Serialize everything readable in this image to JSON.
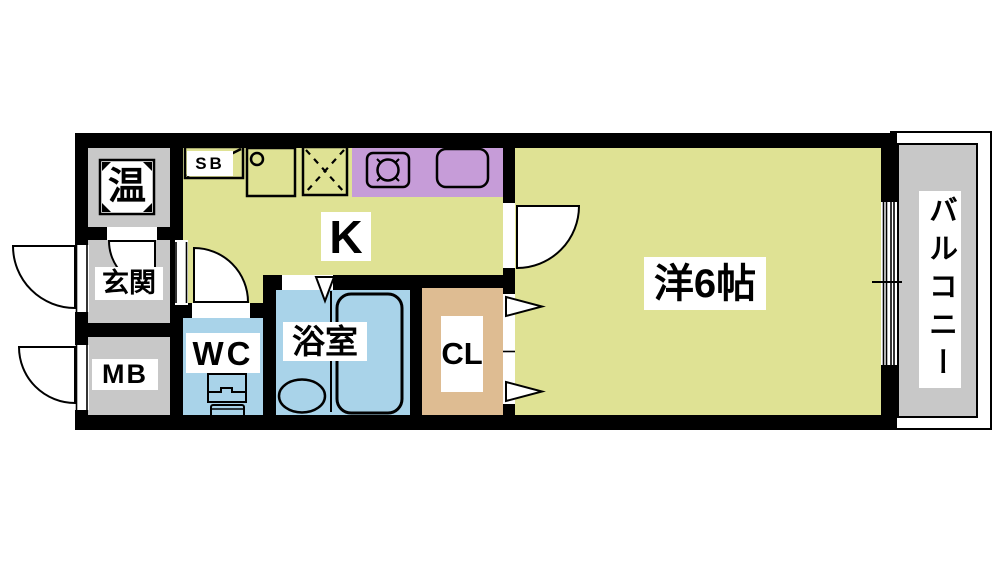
{
  "page": {
    "background": "#ffffff",
    "type_note": "Japanese apartment floor plan (1K layout)"
  },
  "rooms": {
    "kitchen": {
      "label": "K"
    },
    "western_room": {
      "label": "洋6帖"
    },
    "entrance": {
      "label": "玄関"
    },
    "water_heater": {
      "label": "温"
    },
    "meter_box": {
      "label": "MB"
    },
    "toilet": {
      "label": "WC"
    },
    "bathroom": {
      "label": "浴室"
    },
    "closet": {
      "label": "CL"
    },
    "balcony": {
      "label": "バルコニー"
    },
    "shoe_box": {
      "label": "SB"
    }
  },
  "colors": {
    "floor_yellow": "#dfe294",
    "room_gray": "#c8c8c8",
    "water_blue": "#a9d3e9",
    "counter_purple": "#c69cd8",
    "closet_tan": "#debc92",
    "wall_black": "#000000",
    "label_bg": "#ffffff"
  }
}
